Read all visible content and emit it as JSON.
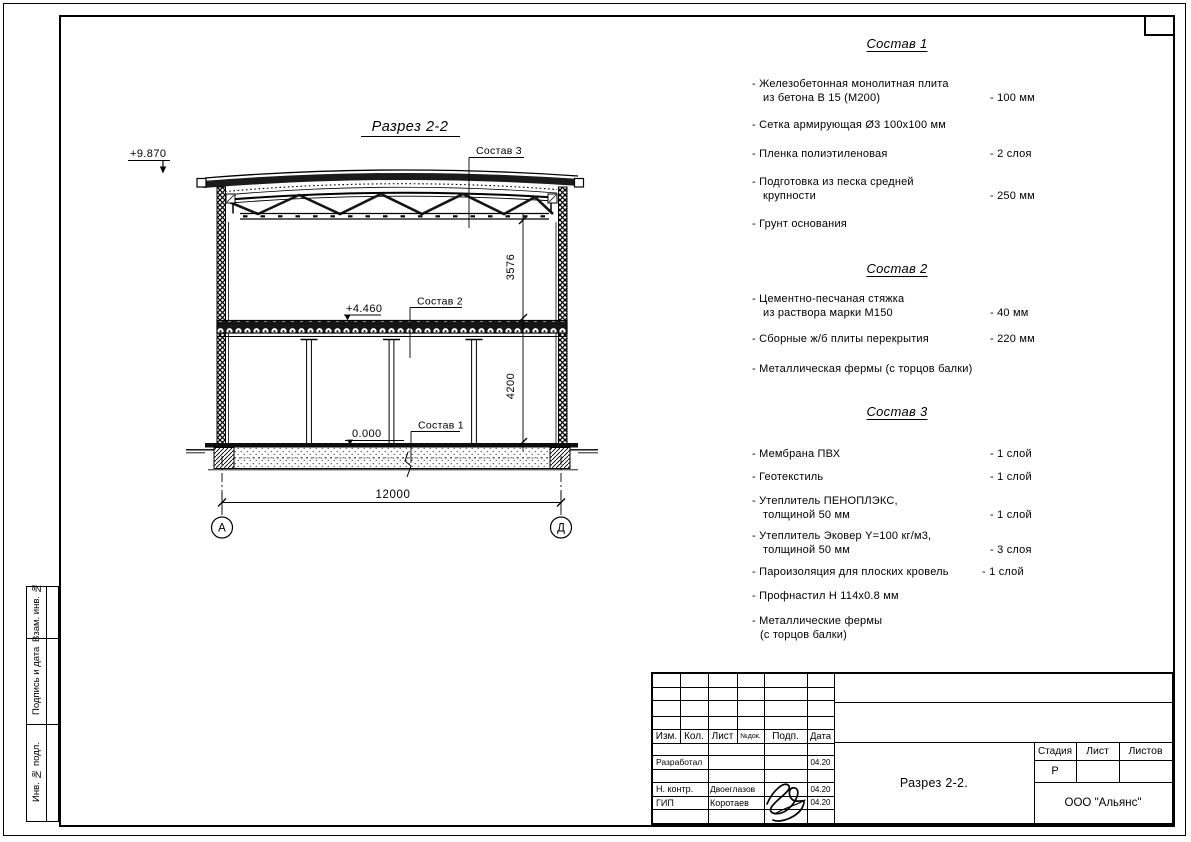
{
  "colors": {
    "ink": "#000000",
    "paper": "#ffffff"
  },
  "drawing": {
    "title": "Разрез 2-2",
    "elevation_roof": "+9.870",
    "elevation_floor": "+4.460",
    "elevation_ground": "0.000",
    "label_sostav1": "Состав 1",
    "label_sostav2": "Состав 2",
    "label_sostav3": "Состав 3",
    "dim_truss": "3576",
    "dim_floor": "4200",
    "dim_span": "12000",
    "axis_left": "А",
    "axis_right": "Д"
  },
  "sections": [
    {
      "title": "Состав 1",
      "items": [
        {
          "lines": [
            "- Железобетонная  монолитная плита",
            "из бетона В 15 (М200)"
          ],
          "value": "- 100 мм"
        },
        {
          "lines": [
            "- Сетка армирующая Ø3 100х100 мм"
          ],
          "value": ""
        },
        {
          "lines": [
            "- Пленка полиэтиленовая"
          ],
          "value": "-  2 слоя"
        },
        {
          "lines": [
            "- Подготовка из песка средней",
            "крупности"
          ],
          "value": "- 250 мм"
        },
        {
          "lines": [
            "- Грунт основания"
          ],
          "value": ""
        }
      ]
    },
    {
      "title": "Состав 2",
      "items": [
        {
          "lines": [
            "- Цементно-песчаная стяжка",
            "из раствора марки М150"
          ],
          "value": "- 40 мм"
        },
        {
          "lines": [
            "- Сборные ж/б плиты перекрытия"
          ],
          "value": "- 220 мм"
        },
        {
          "lines": [
            "- Металлическая фермы (с торцов балки)"
          ],
          "value": ""
        }
      ]
    },
    {
      "title": "Состав 3",
      "items": [
        {
          "lines": [
            "- Мембрана ПВХ"
          ],
          "value": "- 1 слой"
        },
        {
          "lines": [
            "- Геотекстиль"
          ],
          "value": "- 1 слой"
        },
        {
          "lines": [
            "- Утеплитель ПЕНОПЛЭКС,",
            "толщиной 50 мм"
          ],
          "value": "- 1 слой"
        },
        {
          "lines": [
            "- Утеплитель Эковер Y=100 кг/м3,",
            "толщиной 50 мм"
          ],
          "value": "- 3 слоя"
        },
        {
          "lines": [
            "- Пароизоляция для плоских кровель"
          ],
          "value": "- 1 слой"
        },
        {
          "lines": [
            "- Профнастил Н 114х0.8 мм"
          ],
          "value": ""
        },
        {
          "lines": [
            "- Металлические фермы",
            "(с торцов балки)"
          ],
          "value": ""
        }
      ]
    }
  ],
  "title_block": {
    "cols": [
      "Изм.",
      "Кол.",
      "Лист",
      "№док.",
      "Подп.",
      "Дата"
    ],
    "rows": [
      {
        "role": "Разработал",
        "name": "",
        "date": "04.20"
      },
      {
        "role": "Н. контр.",
        "name": "Двоеглазов",
        "date": "04.20"
      },
      {
        "role": "ГИП",
        "name": "Коротаев",
        "date": "04.20"
      }
    ],
    "stage_label": "Стадия",
    "sheet_label": "Лист",
    "sheets_label": "Листов",
    "stage_value": "Р",
    "doc_title": "Разрез 2-2.",
    "company": "ООО \"Альянс\""
  },
  "side_stamp": {
    "labels": [
      "Взам. инв. №",
      "Подпись и дата",
      "Инв. № подл."
    ]
  }
}
